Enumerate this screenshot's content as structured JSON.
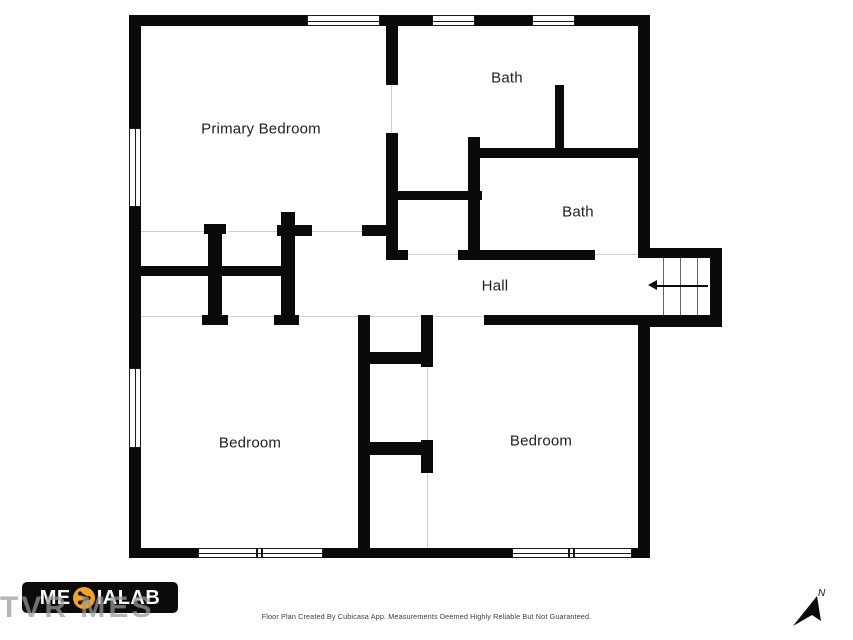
{
  "page": {
    "background": "#ffffff"
  },
  "rooms": [
    {
      "id": "primary-bedroom",
      "label": "Primary Bedroom",
      "cx": 261,
      "cy": 129
    },
    {
      "id": "bath-upper",
      "label": "Bath",
      "cx": 507,
      "cy": 78
    },
    {
      "id": "bath-lower",
      "label": "Bath",
      "cx": 578,
      "cy": 212
    },
    {
      "id": "hall",
      "label": "Hall",
      "cx": 495,
      "cy": 286
    },
    {
      "id": "bedroom-left",
      "label": "Bedroom",
      "cx": 250,
      "cy": 443
    },
    {
      "id": "bedroom-right",
      "label": "Bedroom",
      "cx": 541,
      "cy": 441
    }
  ],
  "stairs": {
    "direction": "left"
  },
  "footer": {
    "logo": {
      "full": "MEDIALAB",
      "text_prefix": "ME",
      "text_suffix": "IALAB",
      "disc_color": "#F2A41E",
      "bg": "#0c0c0c"
    },
    "watermark": "TVR MES",
    "caption": "Floor Plan Created By Cubicasa App. Measurements Deemed Highly Reliable But Not Guaranteed.",
    "compass_label": "N"
  },
  "colors": {
    "wall": "#0a0a0a",
    "door_line": "#cfcfcf",
    "tread_line": "#666666",
    "label_text": "#1f1f1f",
    "caption_text": "#3d3d3d",
    "logo_accent": "#F2A41E",
    "watermark_text": "#999999"
  },
  "geometry": {
    "walls": [
      [
        129,
        15,
        521,
        11
      ],
      [
        129,
        15,
        12,
        543
      ],
      [
        129,
        548,
        521,
        10
      ],
      [
        638,
        15,
        12,
        243
      ],
      [
        638,
        315,
        12,
        243
      ],
      [
        638,
        248,
        84,
        10
      ],
      [
        710,
        248,
        12,
        79
      ],
      [
        638,
        315,
        84,
        12
      ],
      [
        386,
        26,
        12,
        59
      ],
      [
        386,
        133,
        12,
        127
      ],
      [
        362,
        225,
        36,
        11
      ],
      [
        386,
        250,
        22,
        10
      ],
      [
        458,
        250,
        137,
        10
      ],
      [
        555,
        85,
        9,
        70
      ],
      [
        480,
        148,
        170,
        10
      ],
      [
        468,
        137,
        12,
        123
      ],
      [
        387,
        191,
        95,
        9
      ],
      [
        130,
        266,
        163,
        10
      ],
      [
        208,
        224,
        14,
        96
      ],
      [
        204,
        224,
        22,
        10
      ],
      [
        202,
        315,
        26,
        10
      ],
      [
        281,
        212,
        14,
        108
      ],
      [
        277,
        225,
        35,
        11
      ],
      [
        274,
        315,
        25,
        10
      ],
      [
        358,
        315,
        12,
        243
      ],
      [
        421,
        315,
        12,
        52
      ],
      [
        421,
        440,
        12,
        33
      ],
      [
        370,
        352,
        63,
        12
      ],
      [
        370,
        442,
        55,
        13
      ],
      [
        484,
        315,
        166,
        10
      ]
    ],
    "windows": [
      {
        "x": 307,
        "y": 15,
        "w": 73,
        "h": 11,
        "o": "h"
      },
      {
        "x": 432,
        "y": 15,
        "w": 43,
        "h": 11,
        "o": "h"
      },
      {
        "x": 532,
        "y": 15,
        "w": 43,
        "h": 11,
        "o": "h"
      },
      {
        "x": 129,
        "y": 128,
        "w": 12,
        "h": 79,
        "o": "v"
      },
      {
        "x": 129,
        "y": 368,
        "w": 12,
        "h": 80,
        "o": "v"
      },
      {
        "x": 198,
        "y": 548,
        "w": 125,
        "h": 10,
        "o": "h",
        "mullion": 255
      },
      {
        "x": 512,
        "y": 548,
        "w": 120,
        "h": 10,
        "o": "h",
        "mullion": 567
      }
    ],
    "doors": [
      [
        141,
        231,
        63,
        "h"
      ],
      [
        228,
        231,
        49,
        "h"
      ],
      [
        312,
        231,
        50,
        "h"
      ],
      [
        391,
        85,
        48,
        "v"
      ],
      [
        408,
        254,
        50,
        "h"
      ],
      [
        595,
        254,
        43,
        "h"
      ],
      [
        141,
        316,
        61,
        "h"
      ],
      [
        228,
        316,
        46,
        "h"
      ],
      [
        299,
        316,
        59,
        "h"
      ],
      [
        370,
        316,
        51,
        "h"
      ],
      [
        433,
        316,
        51,
        "h"
      ],
      [
        427,
        367,
        73,
        "v"
      ],
      [
        427,
        473,
        75,
        "v"
      ]
    ],
    "treads": [
      [
        663,
        258,
        57
      ],
      [
        680,
        258,
        57
      ],
      [
        697,
        258,
        57
      ]
    ],
    "arrow": {
      "line": [
        657,
        285,
        51,
        2
      ],
      "head": [
        648,
        280
      ]
    }
  }
}
